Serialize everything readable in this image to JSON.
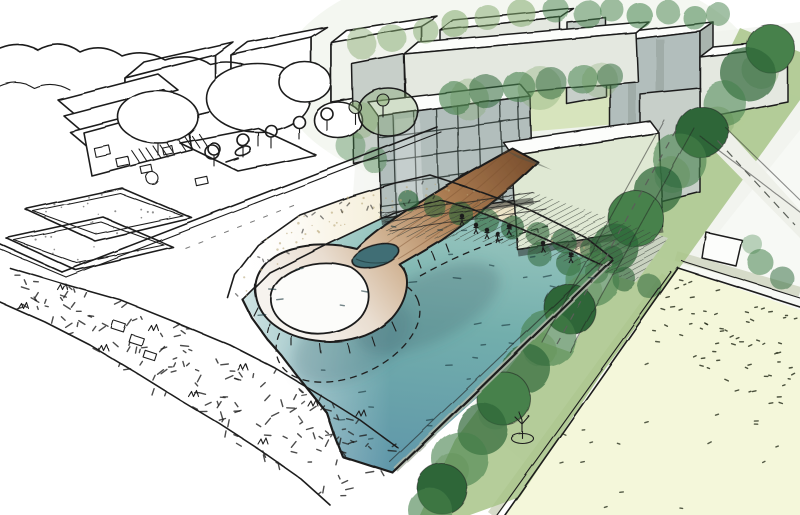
{
  "title": "Hand-drawn aerial perspective sketch of a waterfront masterplan: residential blocks and a looped timber pier over a turquoise basin, tree-lined promenade and lawn fields",
  "medium": "pen sketch with partial watercolor rendering, fading to uncolored line-art on the left",
  "palette": {
    "ink": "#1f1f1f",
    "water_light": "#9cc8c0",
    "water_mid": "#72aeac",
    "water_deep": "#5e95a9",
    "sand": "#f2ebd3",
    "sand_dot": "#b9a87b",
    "lawn": "#f4f7da",
    "lawn_mark": "#2c3320",
    "grass_band": "#a8c488",
    "grass_deep": "#6f9d5e",
    "tree_dark": "#2d6639",
    "tree_mid": "#46814b",
    "tree_light": "#84a96e",
    "wood_dark": "#7d5230",
    "wood_mid": "#ab7c52",
    "wood_pale": "#efe7dc",
    "facade_grey": "#c7cfc9",
    "facade_light": "#e4e8e0",
    "facade_glass": "#b2bebc",
    "facade_green": "#dfe8d3",
    "roof_white": "#fcfdfb",
    "courtyard": "#d7e4bd",
    "terrace": "#c9d2c0",
    "road": "#eef0e9",
    "path_grey": "#d6dbc9",
    "shadow_blue": "#3f6470",
    "water_mark": "#17333a",
    "wash_green": "#dfe8d8"
  },
  "scene": {
    "elements": [
      {
        "name": "water-basin",
        "label": "Turquoise water basin"
      },
      {
        "name": "looped-timber-pier",
        "label": "Looped timber pier with two oval openings"
      },
      {
        "name": "sand-beach",
        "label": "Sandy beach strip"
      },
      {
        "name": "waterfront-terraces",
        "label": "Stepped waterfront terraces"
      },
      {
        "name": "residential-blocks",
        "label": "Residential building blocks"
      },
      {
        "name": "glazed-facade-building",
        "label": "Gridded glass facade block"
      },
      {
        "name": "courtyard-trees",
        "label": "Green courtyard with trees"
      },
      {
        "name": "tree-lined-promenade",
        "label": "Diagonal tree-lined promenade"
      },
      {
        "name": "lawn-field",
        "label": "Large pale lawn field with people"
      },
      {
        "name": "sports-courts",
        "label": "Sketched sports courts"
      },
      {
        "name": "plaza-sketch",
        "label": "Uncolored plaza sketch with kiosks and crosswalks"
      },
      {
        "name": "beach-vegetation-band",
        "label": "Dotted dune vegetation band"
      },
      {
        "name": "pedestrians",
        "label": "Tiny sketched pedestrians"
      }
    ]
  }
}
